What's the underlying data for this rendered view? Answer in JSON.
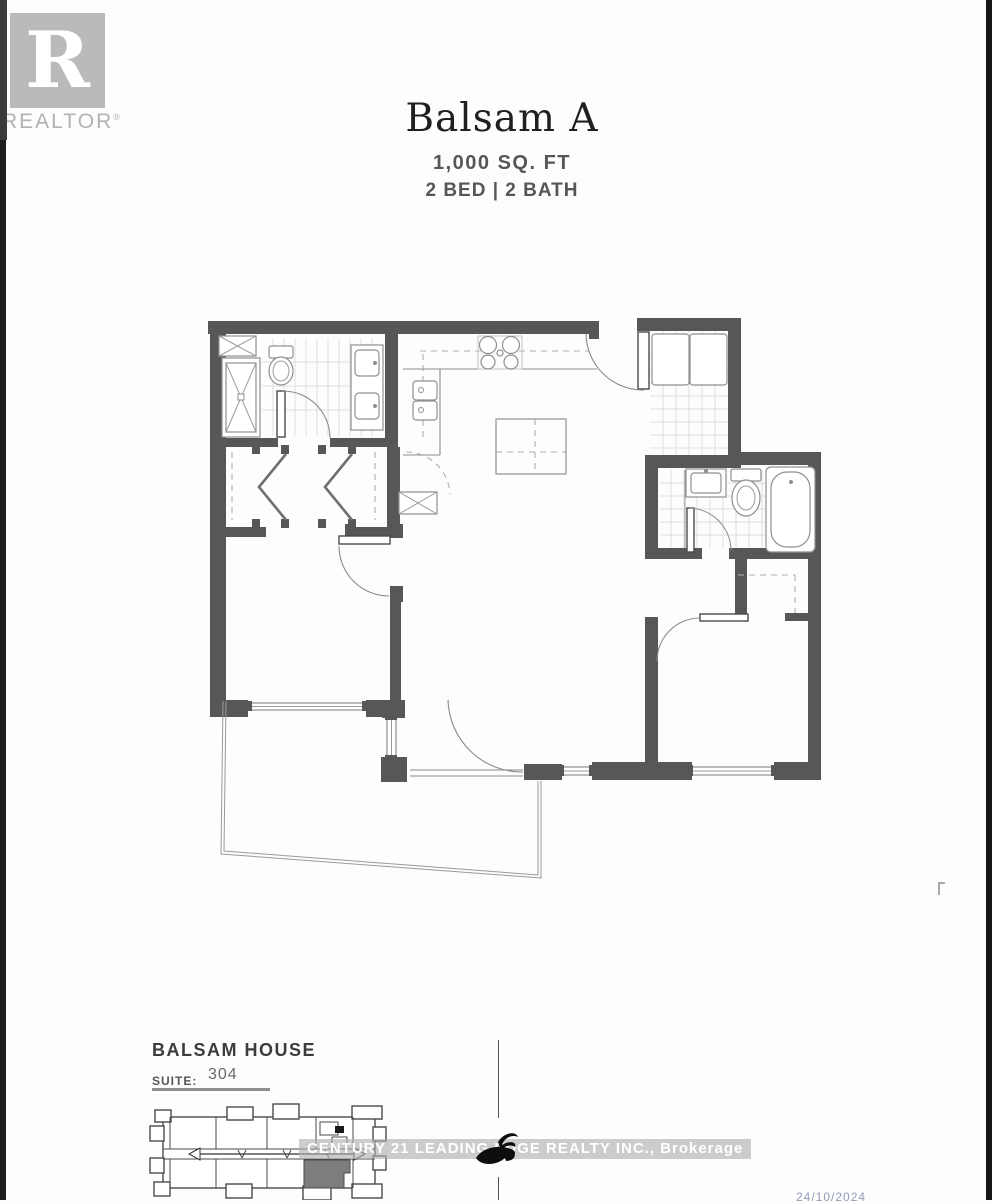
{
  "page": {
    "background": "#fdfdfd",
    "edge_strip_color": "#1e1e1e"
  },
  "branding": {
    "realtor_logo": {
      "letter": "R",
      "label": "REALTOR",
      "registered_mark": "®"
    },
    "watermark_text": "CENTURY 21 LEADING EDGE REALTY INC., Brokerage",
    "century21_swirl_icon": "black calligraphic swoosh"
  },
  "header": {
    "title": "Balsam A",
    "area": "1,000 SQ. FT",
    "config": "2 BED  |  2 BATH"
  },
  "floor_plan": {
    "rooms": [
      "bathroom-1",
      "walk-in-closet-hall",
      "bedroom-1",
      "kitchen",
      "living-dining",
      "laundry-closet",
      "bathroom-2",
      "bedroom-2",
      "balcony"
    ],
    "fixtures": [
      "shower",
      "toilet",
      "double-vanity",
      "bifold-closet-doors",
      "cooktop",
      "kitchen-sink",
      "dining-table",
      "washer-dryer",
      "vanity-sink",
      "bathtub",
      "entry-door",
      "windows"
    ]
  },
  "footer": {
    "building_name": "BALSAM HOUSE",
    "suite_label": "SUITE:",
    "suite_number": "304",
    "date_stamp": "24/10/2024",
    "key_plan": "building footprint with highlighted suite and corridor arrow"
  },
  "colors": {
    "wall": "#57575a",
    "thin_line": "#8a8a8a",
    "tile_line": "#d6d6d6",
    "dashed_line": "#b0b0b0",
    "highlighted_unit": "#7d7d7d",
    "logo_gray": "#b9bab9",
    "title_text": "#1f1f1f",
    "subtitle_text": "#56565a",
    "watermark_band": "rgba(175,175,175,0.62)",
    "date_text": "#3b4a7a"
  }
}
